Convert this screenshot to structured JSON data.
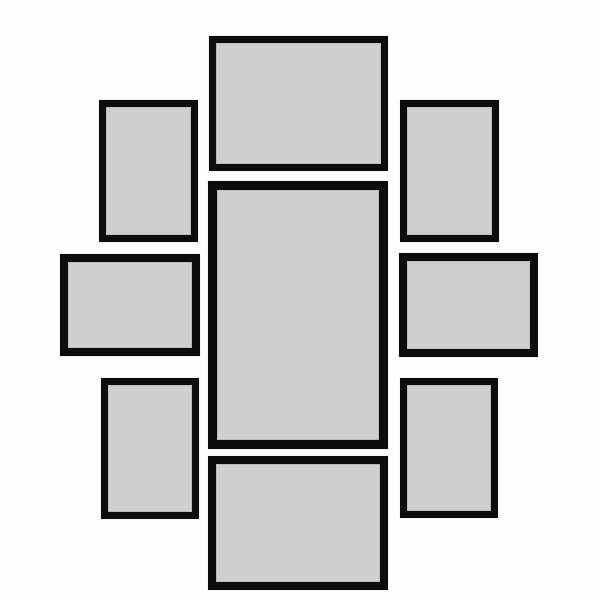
{
  "scene": {
    "description": "Nine-piece black gallery wall picture frame collage with empty gray mats on a white background",
    "background_color": "#fefefe",
    "frame_count": 9
  },
  "frame_style": {
    "border_color": "#0d0d0d",
    "mat_color": "#d1ced0",
    "inner_seam_color": "#bebbbc"
  },
  "frames": [
    {
      "id": "frame-top-center",
      "orientation": "landscape",
      "x": 209,
      "y": 36,
      "width": 179,
      "height": 135,
      "border": 7
    },
    {
      "id": "frame-center",
      "orientation": "portrait",
      "x": 208,
      "y": 181,
      "width": 180,
      "height": 268,
      "border": 9
    },
    {
      "id": "frame-bottom-center",
      "orientation": "landscape",
      "x": 208,
      "y": 456,
      "width": 180,
      "height": 134,
      "border": 8
    },
    {
      "id": "frame-top-left",
      "orientation": "portrait",
      "x": 99,
      "y": 100,
      "width": 99,
      "height": 142,
      "border": 7
    },
    {
      "id": "frame-top-right",
      "orientation": "portrait",
      "x": 400,
      "y": 100,
      "width": 99,
      "height": 142,
      "border": 7
    },
    {
      "id": "frame-middle-left",
      "orientation": "landscape",
      "x": 60,
      "y": 254,
      "width": 140,
      "height": 102,
      "border": 8
    },
    {
      "id": "frame-middle-right",
      "orientation": "landscape",
      "x": 399,
      "y": 253,
      "width": 139,
      "height": 104,
      "border": 8
    },
    {
      "id": "frame-bottom-left",
      "orientation": "portrait",
      "x": 101,
      "y": 378,
      "width": 98,
      "height": 141,
      "border": 7
    },
    {
      "id": "frame-bottom-right",
      "orientation": "portrait",
      "x": 400,
      "y": 378,
      "width": 98,
      "height": 140,
      "border": 7
    }
  ]
}
